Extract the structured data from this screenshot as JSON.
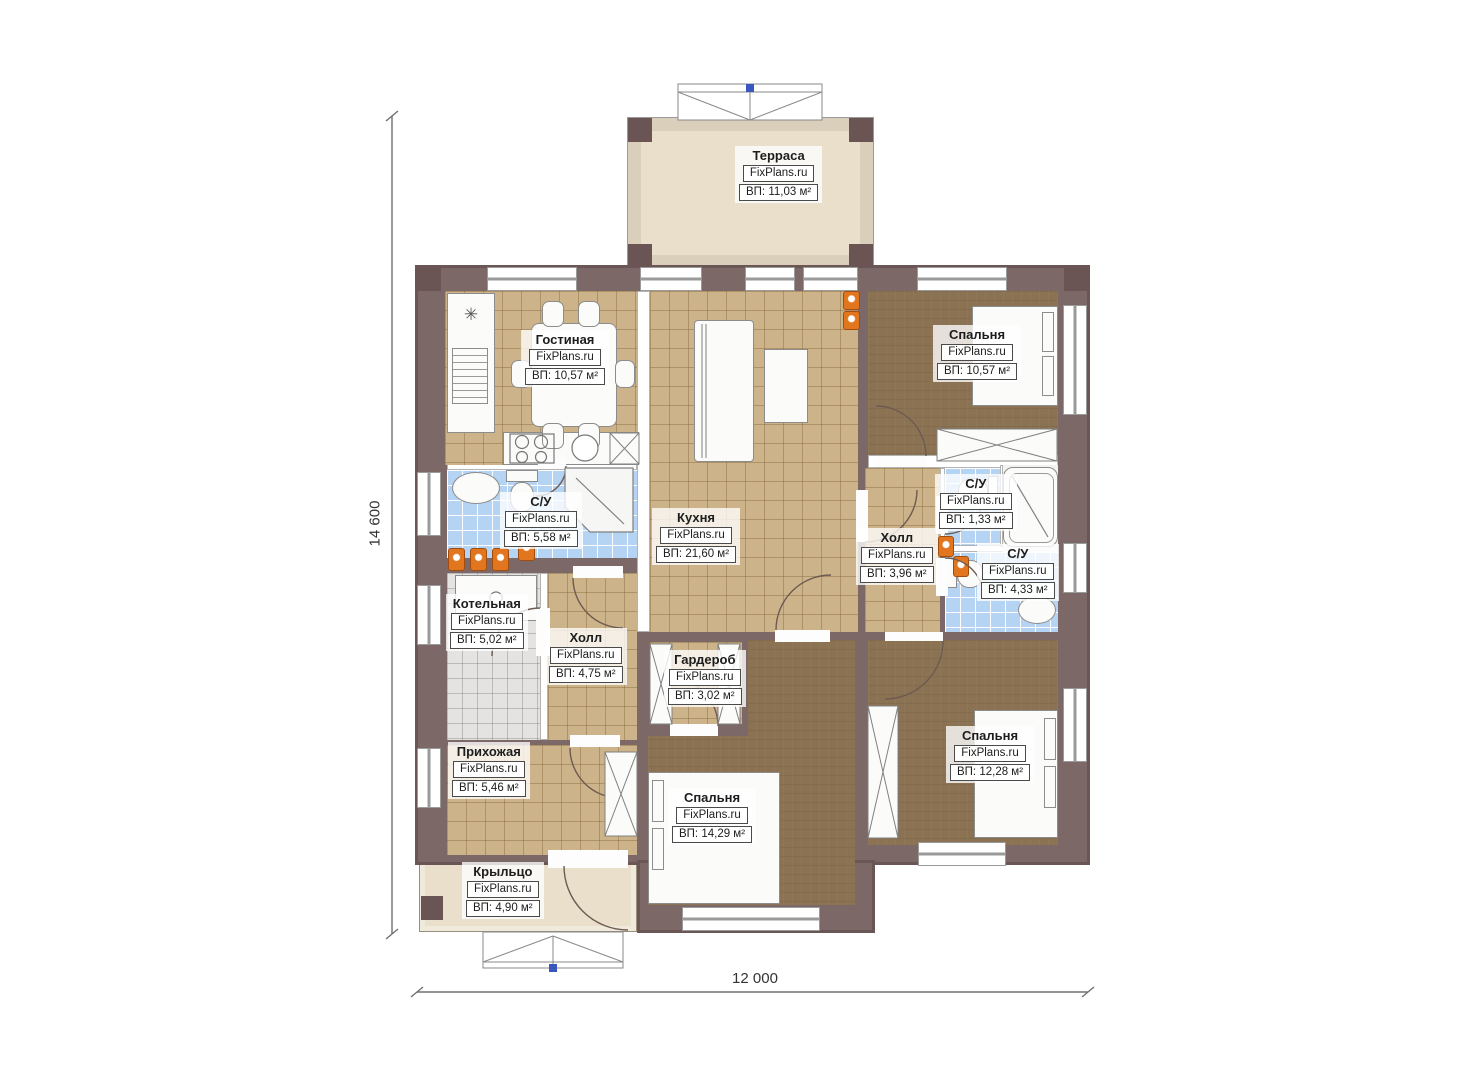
{
  "watermark": "FixPlans.ru",
  "dimensions": {
    "height_label": "14 600",
    "width_label": "12 000"
  },
  "rooms": {
    "terrace": {
      "name": "Терраса",
      "area": "ВП: 11,03 м²"
    },
    "living": {
      "name": "Гостиная",
      "area": "ВП: 10,57 м²"
    },
    "bedroom1": {
      "name": "Спальня",
      "area": "ВП: 10,57 м²"
    },
    "bath1": {
      "name": "С/У",
      "area": "ВП: 5,58 м²"
    },
    "kitchen": {
      "name": "Кухня",
      "area": "ВП: 21,60 м²"
    },
    "hall1": {
      "name": "Холл",
      "area": "ВП: 3,96 м²"
    },
    "wc": {
      "name": "С/У",
      "area": "ВП: 1,33 м²"
    },
    "bath2": {
      "name": "С/У",
      "area": "ВП: 4,33 м²"
    },
    "boiler": {
      "name": "Котельная",
      "area": "ВП: 5,02 м²"
    },
    "hall2": {
      "name": "Холл",
      "area": "ВП: 4,75 м²"
    },
    "wardrobe": {
      "name": "Гардероб",
      "area": "ВП: 3,02 м²"
    },
    "entry": {
      "name": "Прихожая",
      "area": "ВП: 5,46 м²"
    },
    "bedroom2": {
      "name": "Спальня",
      "area": "ВП: 14,29 м²"
    },
    "bedroom3": {
      "name": "Спальня",
      "area": "ВП: 12,28 м²"
    },
    "porch": {
      "name": "Крыльцо",
      "area": "ВП: 4,90 м²"
    }
  },
  "colors": {
    "wall": "#7d6868",
    "wallDark": "#6b5454",
    "tan": "#cdb389",
    "brown": "#8a7252",
    "blue": "#b5d3f2",
    "gray": "#e4e3e1",
    "terrace": "#e9dfcb",
    "terraceWall": "#d9cfba",
    "orange": "#e2761f"
  }
}
